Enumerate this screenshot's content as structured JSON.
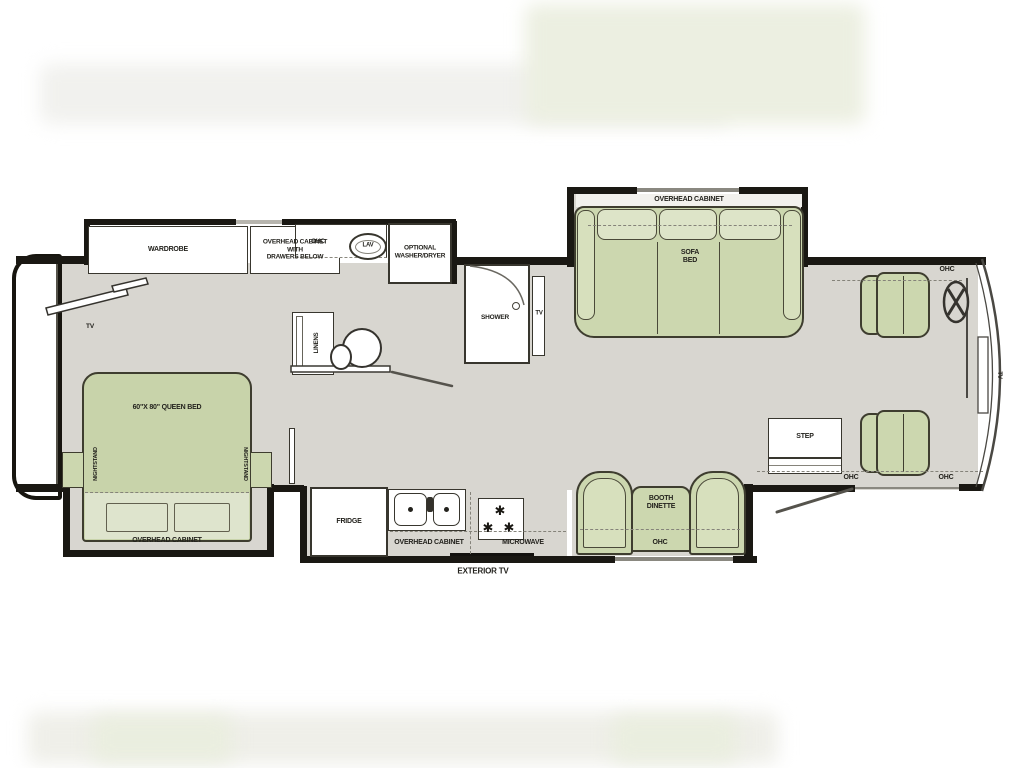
{
  "diagram": "rv-motorhome-floor-plan",
  "colors": {
    "floor": "#d8d6d0",
    "furniture_green": "#ccd7af",
    "furniture_green_light": "#dde4c8",
    "wall": "#1a1813",
    "line": "#44423a"
  },
  "labels": {
    "wardrobe": "WARDROBE",
    "overhead_cabinet_with_drawers": "OVERHEAD CABINET\nWITH\nDRAWERS BELOW",
    "ohc_bath": "OHC",
    "lav": "LAV",
    "optional_washer_dryer": "OPTIONAL\nWASHER/DRYER",
    "linens": "LINENS",
    "shower": "SHOWER",
    "tv_bath": "TV",
    "tv_bedroom": "TV",
    "queen_bed": "60\"X 80\" QUEEN BED",
    "nightstand_left": "NIGHTSTAND",
    "nightstand_right": "NIGHTSTAND",
    "overhead_cabinet_bed": "OVERHEAD CABINET",
    "fridge": "FRIDGE",
    "overhead_cabinet_kitchen": "OVERHEAD CABINET",
    "microwave": "MICROWAVE",
    "exterior_tv": "EXTERIOR TV",
    "overhead_cabinet_sofa": "OVERHEAD CABINET",
    "sofa_bed": "SOFA\nBED",
    "booth_dinette": "BOOTH\nDINETTE",
    "ohc_dinette": "OHC",
    "step": "STEP",
    "ohc_entry": "OHC",
    "ohc_cockpit_top": "OHC",
    "ohc_cockpit_bottom": "OHC",
    "tv_front": "TV"
  }
}
